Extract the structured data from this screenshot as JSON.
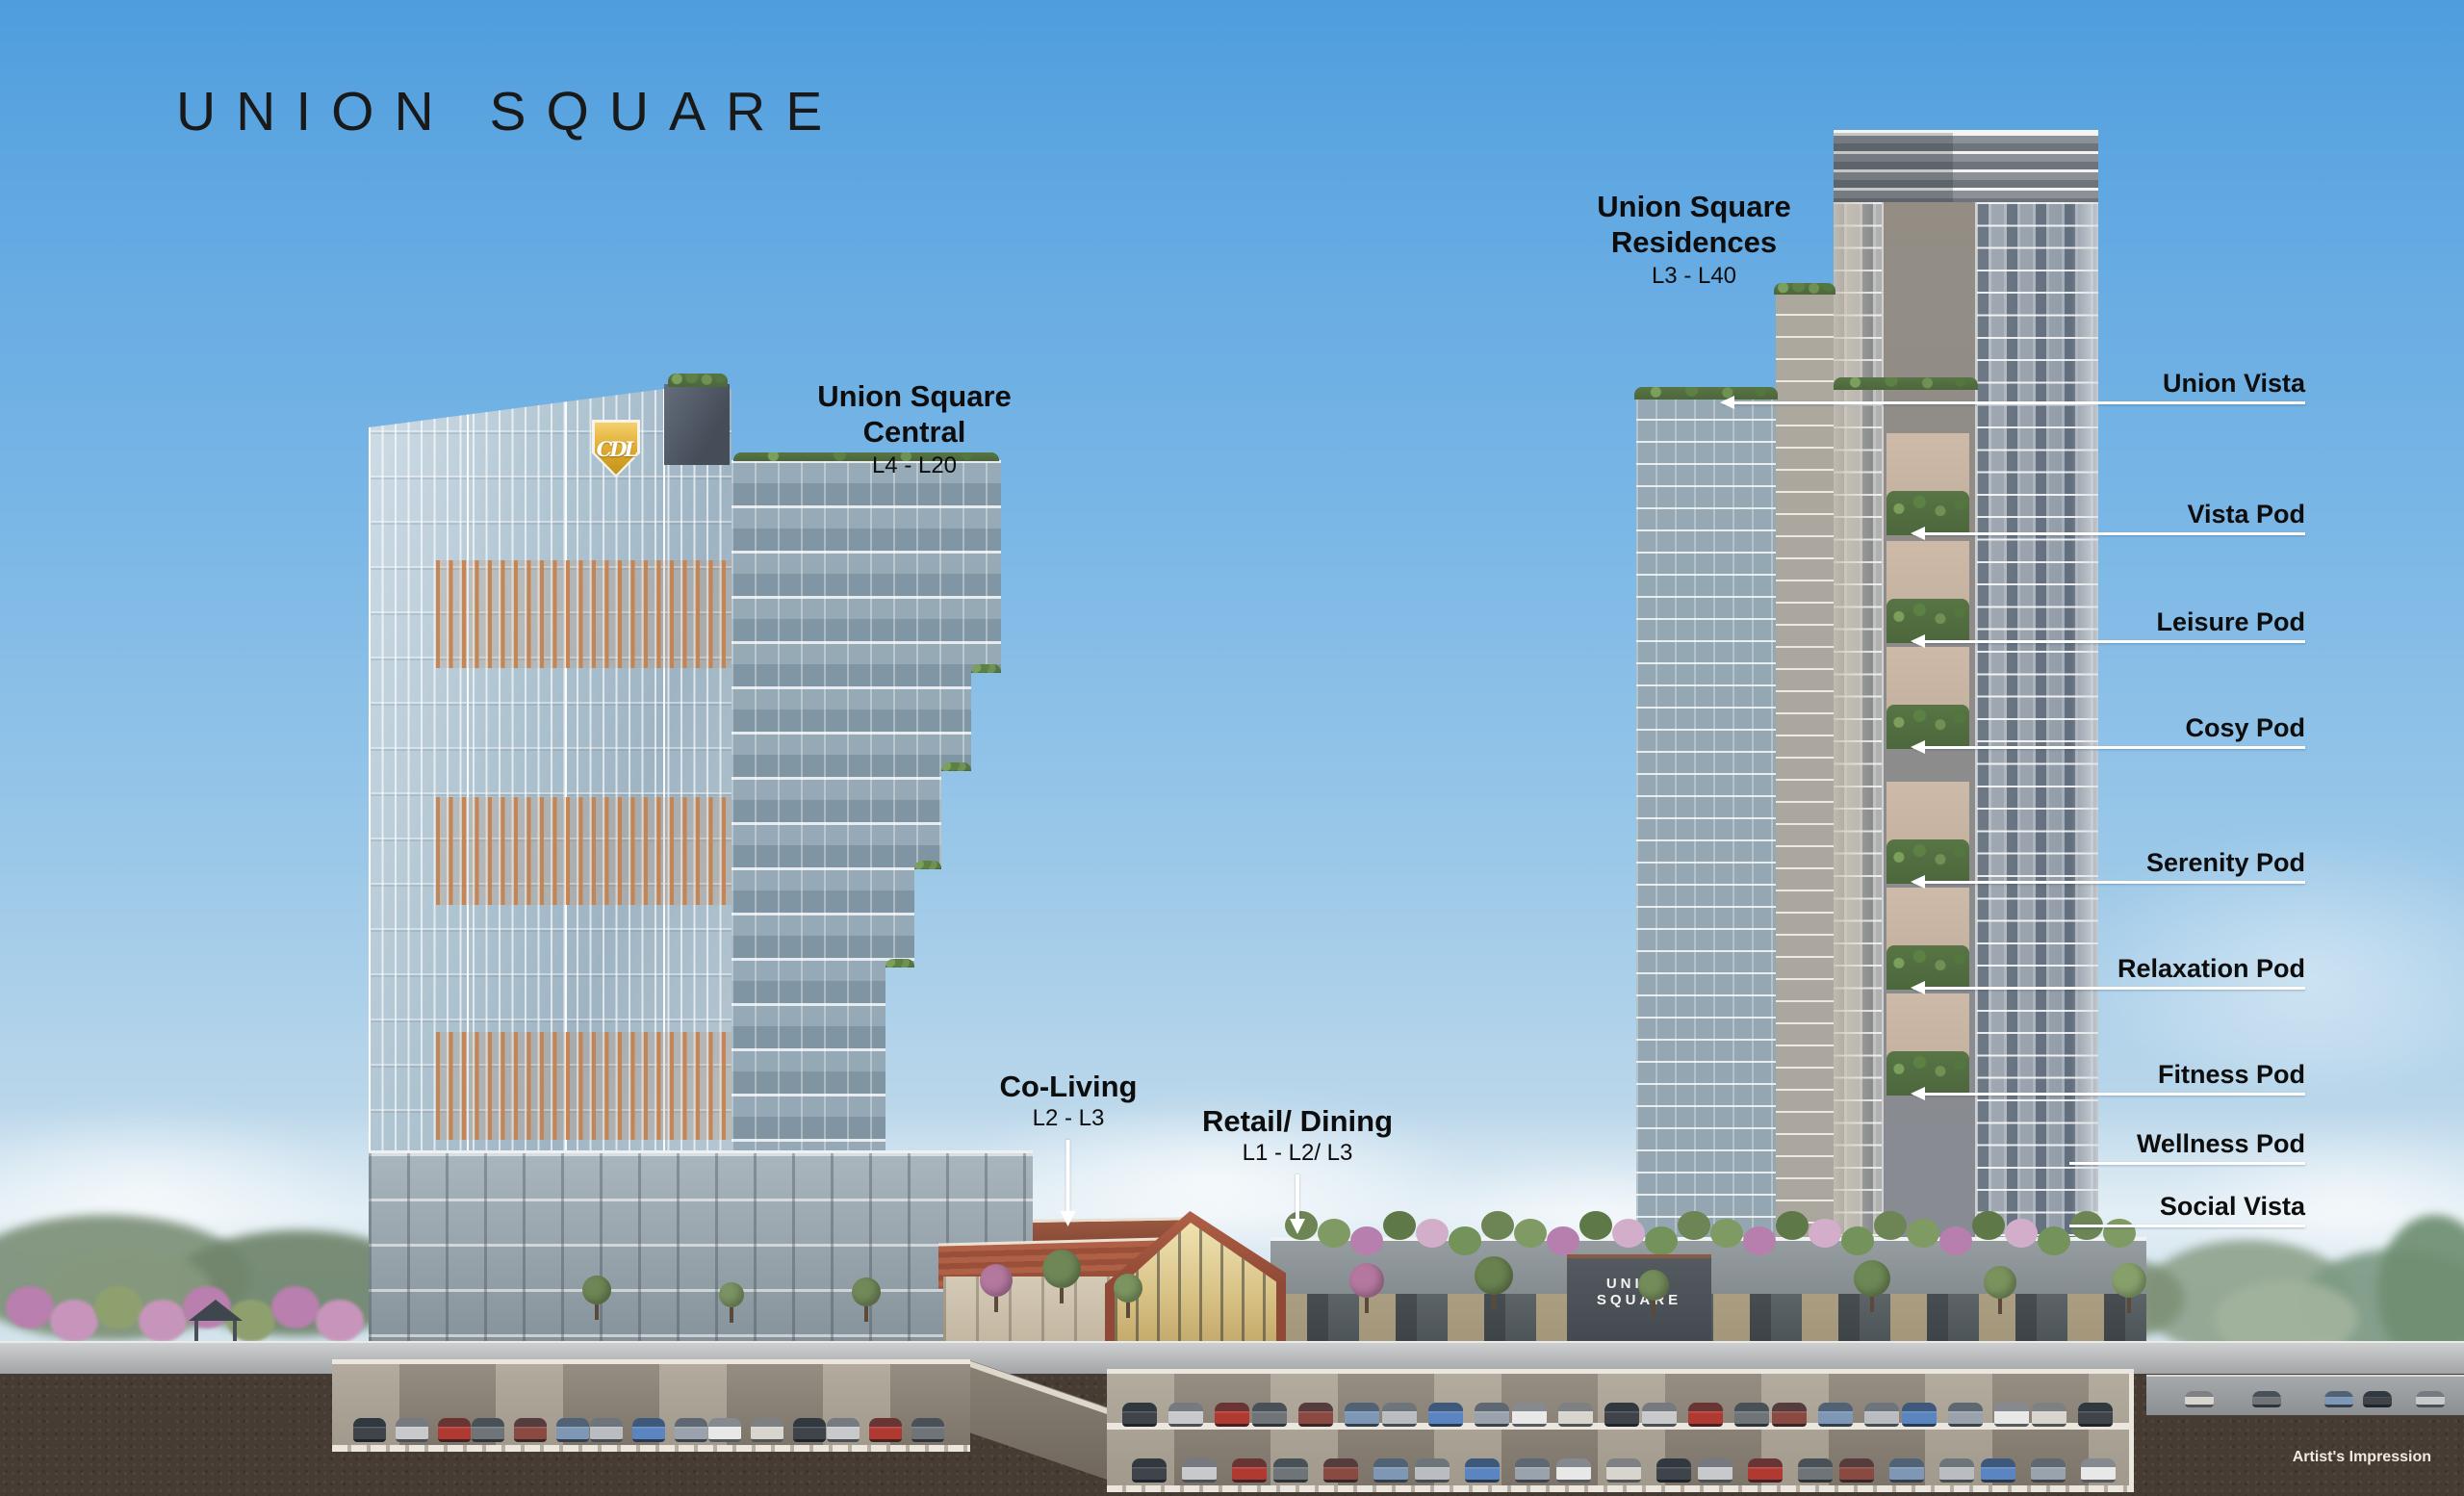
{
  "page": {
    "title": "UNION SQUARE",
    "watermark": "Artist's Impression"
  },
  "logos": {
    "developer_monogram": "CDL",
    "podium_sign": "UNION SQUARE"
  },
  "towers": {
    "central": {
      "name_line1": "Union Square",
      "name_line2": "Central",
      "levels": "L4 - L20"
    },
    "residences": {
      "name_line1": "Union Square",
      "name_line2": "Residences",
      "levels": "L3 - L40"
    }
  },
  "amenity_callouts": {
    "items": [
      {
        "label": "Union Vista"
      },
      {
        "label": "Vista Pod"
      },
      {
        "label": "Leisure Pod"
      },
      {
        "label": "Cosy Pod"
      },
      {
        "label": "Serenity Pod"
      },
      {
        "label": "Relaxation Pod"
      },
      {
        "label": "Fitness Pod"
      },
      {
        "label": "Wellness Pod"
      },
      {
        "label": "Social Vista"
      }
    ]
  },
  "ground_callouts": {
    "co_living": {
      "label": "Co-Living",
      "levels": "L2 - L3"
    },
    "retail_dining": {
      "label": "Retail/ Dining",
      "levels": "L1 - L2/ L3"
    }
  },
  "colors": {
    "sky_top": "#4f9ddd",
    "sky_horizon": "#dde9ef",
    "label_text": "#0d0d0d",
    "callout_line": "#ffffff",
    "logo_gold": "#dca82b",
    "terracotta_roof": "#a85c42",
    "earth": "#463c33"
  }
}
